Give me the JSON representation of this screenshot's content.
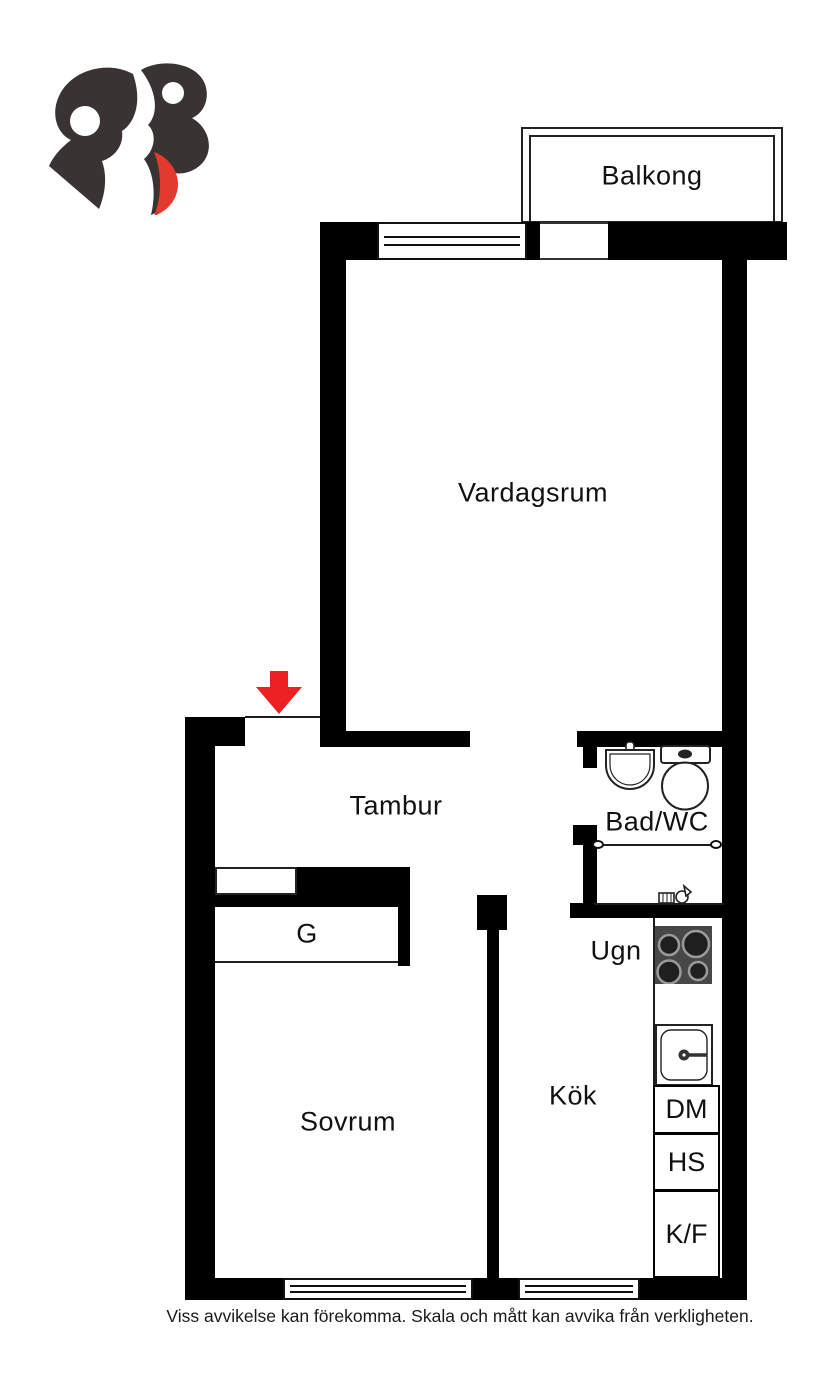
{
  "meta": {
    "type": "floor-plan",
    "language": "sv"
  },
  "logo": {
    "name": "RB broker monogram",
    "dark_color": "#393333",
    "accent_color": "#e23b2e"
  },
  "rooms": {
    "balkong": "Balkong",
    "vardagsrum": "Vardagsrum",
    "tambur": "Tambur",
    "bad_wc": "Bad/WC",
    "sovrum": "Sovrum",
    "kok": "Kök",
    "garderob": "G",
    "ugn": "Ugn"
  },
  "kitchen": {
    "appliances": [
      {
        "code": "DM"
      },
      {
        "code": "HS"
      },
      {
        "code": "K/F"
      }
    ]
  },
  "footer": {
    "disclaimer": "Viss avvikelse kan förekomma. Skala och mått kan avvika från verkligheten."
  },
  "colors": {
    "wall": "#000000",
    "entrance_arrow": "#ed2024",
    "stove_top": "#474747",
    "logo_dark": "#393333",
    "logo_red": "#e23b2e"
  }
}
